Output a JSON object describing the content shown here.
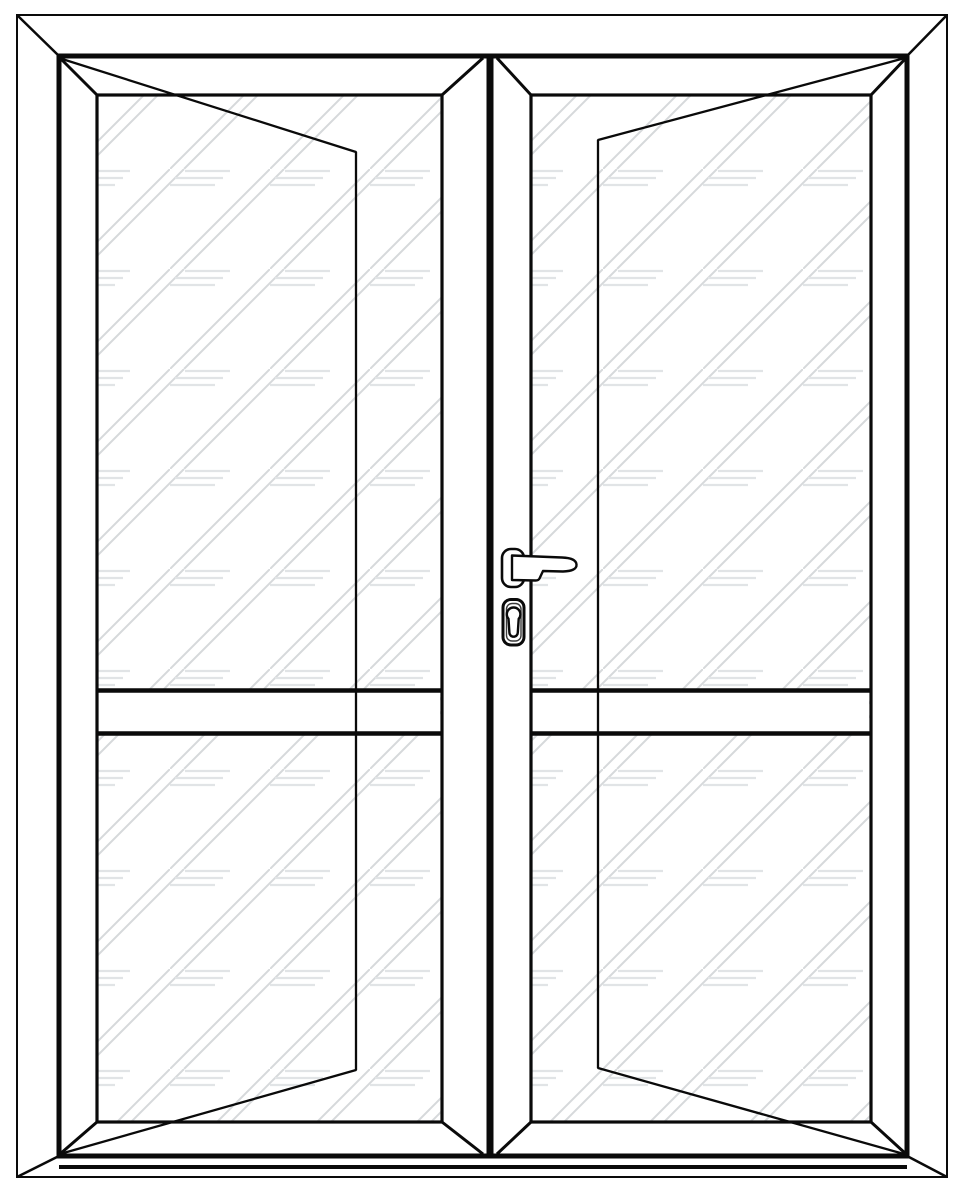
{
  "meta": {
    "type": "technical-elevation-drawing",
    "subject": "double-glazed french door, front elevation, no text labels"
  },
  "canvas": {
    "width": 964,
    "height": 1184,
    "background": "#ffffff"
  },
  "palette": {
    "line": "#0a0a0a",
    "line_soft": "#3a3a3a",
    "glass_hatch": "#d6d9db",
    "glass_mark": "#e1e4e6",
    "fill": "#ffffff"
  },
  "drawing": {
    "outer_frame": {
      "x": 17,
      "y": 15,
      "w": 930,
      "h": 1162,
      "stroke": 2
    },
    "inner_frame": {
      "x": 59,
      "y": 56,
      "w": 848,
      "h": 1100,
      "stroke": 5
    },
    "frame_miters": {
      "stroke": 2.5,
      "lines": [
        [
          17,
          15,
          59,
          56
        ],
        [
          947,
          15,
          907,
          56
        ],
        [
          17,
          1177,
          59,
          1156
        ],
        [
          947,
          1177,
          907,
          1156
        ]
      ]
    },
    "threshold": {
      "x1": 59,
      "x2": 907,
      "y": 1167,
      "stroke": 4
    },
    "meeting_stile": {
      "x": 490,
      "y1": 56,
      "y2": 1156,
      "stroke": 7
    },
    "glass_texture": {
      "tile": 100,
      "hatch_width": 2,
      "mark_width": 2.2,
      "hatch_lines": [
        [
          0,
          100,
          100,
          0
        ],
        [
          14,
          100,
          114,
          0
        ],
        [
          -86,
          100,
          14,
          0
        ]
      ],
      "mark_lines": [
        [
          15,
          2,
          60,
          2
        ],
        [
          5,
          9,
          53,
          9
        ],
        [
          0,
          16,
          45,
          16
        ]
      ]
    },
    "leaves": [
      {
        "name": "left-door-leaf",
        "pattern_id": "glass-left",
        "pattern_origin": [
          170,
          169
        ],
        "glass": {
          "x": 97,
          "y": 95,
          "w": 345,
          "h": 1027,
          "stroke": 3.2
        },
        "miters": {
          "stroke": 3,
          "lines": [
            [
              60,
              58,
              97,
              95
            ],
            [
              483,
              58,
              442,
              95
            ],
            [
              60,
              1154,
              97,
              1122
            ],
            [
              483,
              1154,
              442,
              1122
            ]
          ]
        },
        "midrail": {
          "band": [
            99,
            689,
            341,
            46
          ],
          "x1": 98,
          "x2": 441,
          "lines_y": [
            690.5,
            733.5
          ],
          "stroke": 4.5
        },
        "swing": {
          "stroke": 2.3,
          "points": "59,58 356,152 356,1070 60,1154"
        }
      },
      {
        "name": "right-door-leaf",
        "pattern_id": "glass-right",
        "pattern_origin": [
          603,
          169
        ],
        "glass": {
          "x": 531,
          "y": 95,
          "w": 340,
          "h": 1027,
          "stroke": 3.2
        },
        "miters": {
          "stroke": 3,
          "lines": [
            [
              497,
              58,
              531,
              95
            ],
            [
              906,
              58,
              871,
              95
            ],
            [
              497,
              1154,
              531,
              1122
            ],
            [
              906,
              1154,
              871,
              1122
            ]
          ]
        },
        "midrail": {
          "band": [
            533,
            689,
            336,
            46
          ],
          "x1": 532,
          "x2": 870,
          "lines_y": [
            690.5,
            733.5
          ],
          "stroke": 4.5
        },
        "swing": {
          "stroke": 2.3,
          "points": "905,58 598,140 598,1068 904,1154"
        }
      }
    ],
    "hardware": {
      "backplate": {
        "x": 502,
        "y": 549,
        "w": 22,
        "h": 38,
        "r": 9,
        "stroke": 2.6
      },
      "lever": {
        "stroke": 2.4,
        "path": "M 512,555.5 L 562,557.5 Q 576,558 576.5,564.5 Q 577,571 563,571.5 L 543,571 L 539.5,578.5 Q 538.5,580.5 535.5,580.5 L 512,580 Z"
      },
      "escutcheon": {
        "x": 503,
        "y": 599.5,
        "w": 21,
        "h": 45.5,
        "r": 8,
        "stroke": 3
      },
      "escutcheon_inner": {
        "x": 506.5,
        "y": 603.5,
        "w": 14.5,
        "h": 37.5,
        "r": 5.5,
        "stroke": 1.4
      },
      "cylinder": {
        "stroke": 2.4,
        "path": "M 508.5,618.8 A 6.8,6.8 0 1 1 518.7,618.8 L 517.8,632.5 A 4.2,4.2 0 0 1 509.4,632.5 Z"
      }
    }
  }
}
